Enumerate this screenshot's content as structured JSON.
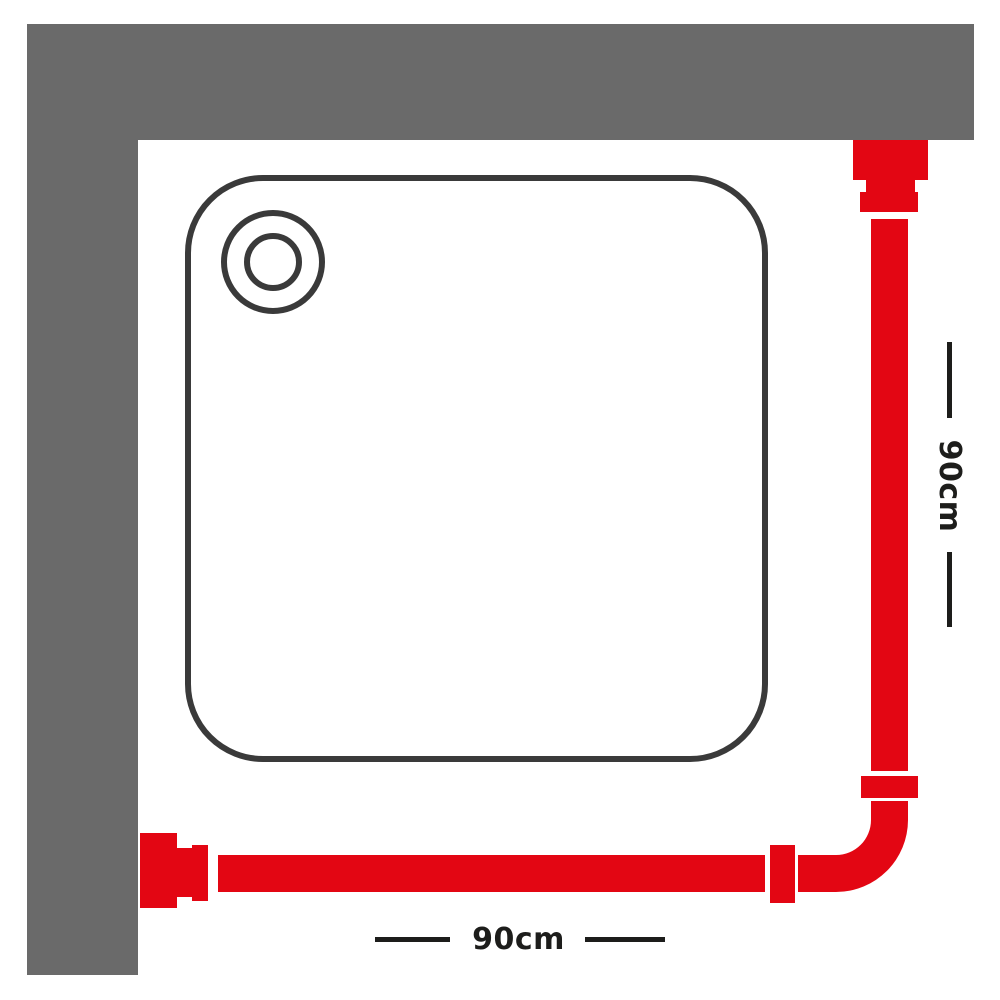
{
  "diagram": {
    "title": "corner-shower-curtain-rail-dimension-diagram",
    "colors": {
      "background": "#ffffff",
      "wall_gray": "#6a6a6a",
      "rail_red": "#e30613",
      "tray_outline_dark": "#3a3a3a",
      "dimension_black": "#1d1d1b"
    },
    "dimensions": {
      "bottom": {
        "label": "90cm"
      },
      "right": {
        "label": "90cm"
      }
    },
    "icons": {
      "wall": "corner-wall-icon",
      "tray": "square-shower-tray-icon",
      "drain": "drain-circles-icon",
      "rail": "l-shaped-curtain-rail-icon",
      "bracket_top": "wall-bracket-icon",
      "bracket_bottom": "wall-bracket-icon",
      "coupler_vertical": "rail-coupler-icon",
      "coupler_horizontal": "rail-coupler-icon"
    }
  }
}
